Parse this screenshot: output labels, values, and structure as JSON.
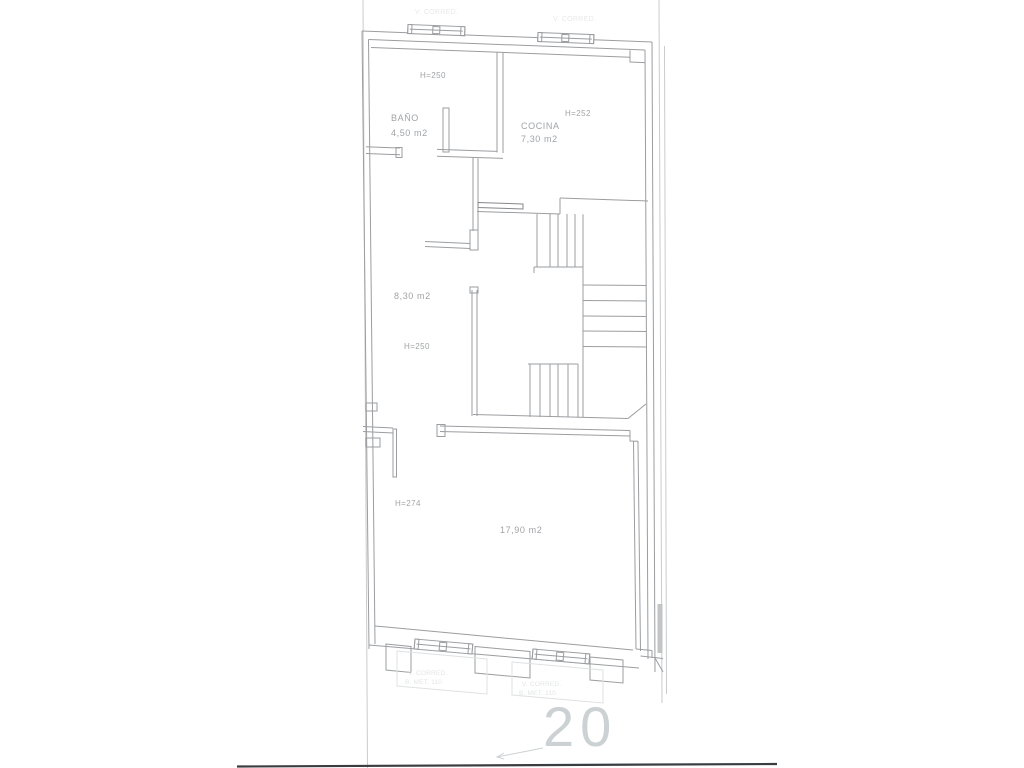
{
  "plan": {
    "number": "20",
    "rooms": {
      "bath": {
        "name": "BAÑO",
        "area": "4,50 m2",
        "height": "H=250"
      },
      "kitchen": {
        "name": "COCINA",
        "area": "7,30 m2",
        "height": "H=252"
      },
      "hall": {
        "name": "",
        "area": "8,30 m2",
        "height": "H=250"
      },
      "living": {
        "name": "",
        "area": "17,90 m2",
        "height": "H=274"
      }
    },
    "faint_annotations": {
      "window_top_left": "V. CORRED.",
      "window_top_right": "V. CORRED.",
      "balcony_left_line1": "V. CORRED.",
      "balcony_left_line2": "B. MET. 110",
      "balcony_right_line1": "V. CORRED.",
      "balcony_right_line2": "B. MET. 110"
    },
    "colors": {
      "wall_line": "#9b9da0",
      "faint_line": "#dfe1e2",
      "boundary_line": "#c9cbcd",
      "dark_baseline": "#3a3d40",
      "label_text": "#a0a3a6",
      "plan_number_text": "#ccd1d4"
    }
  }
}
